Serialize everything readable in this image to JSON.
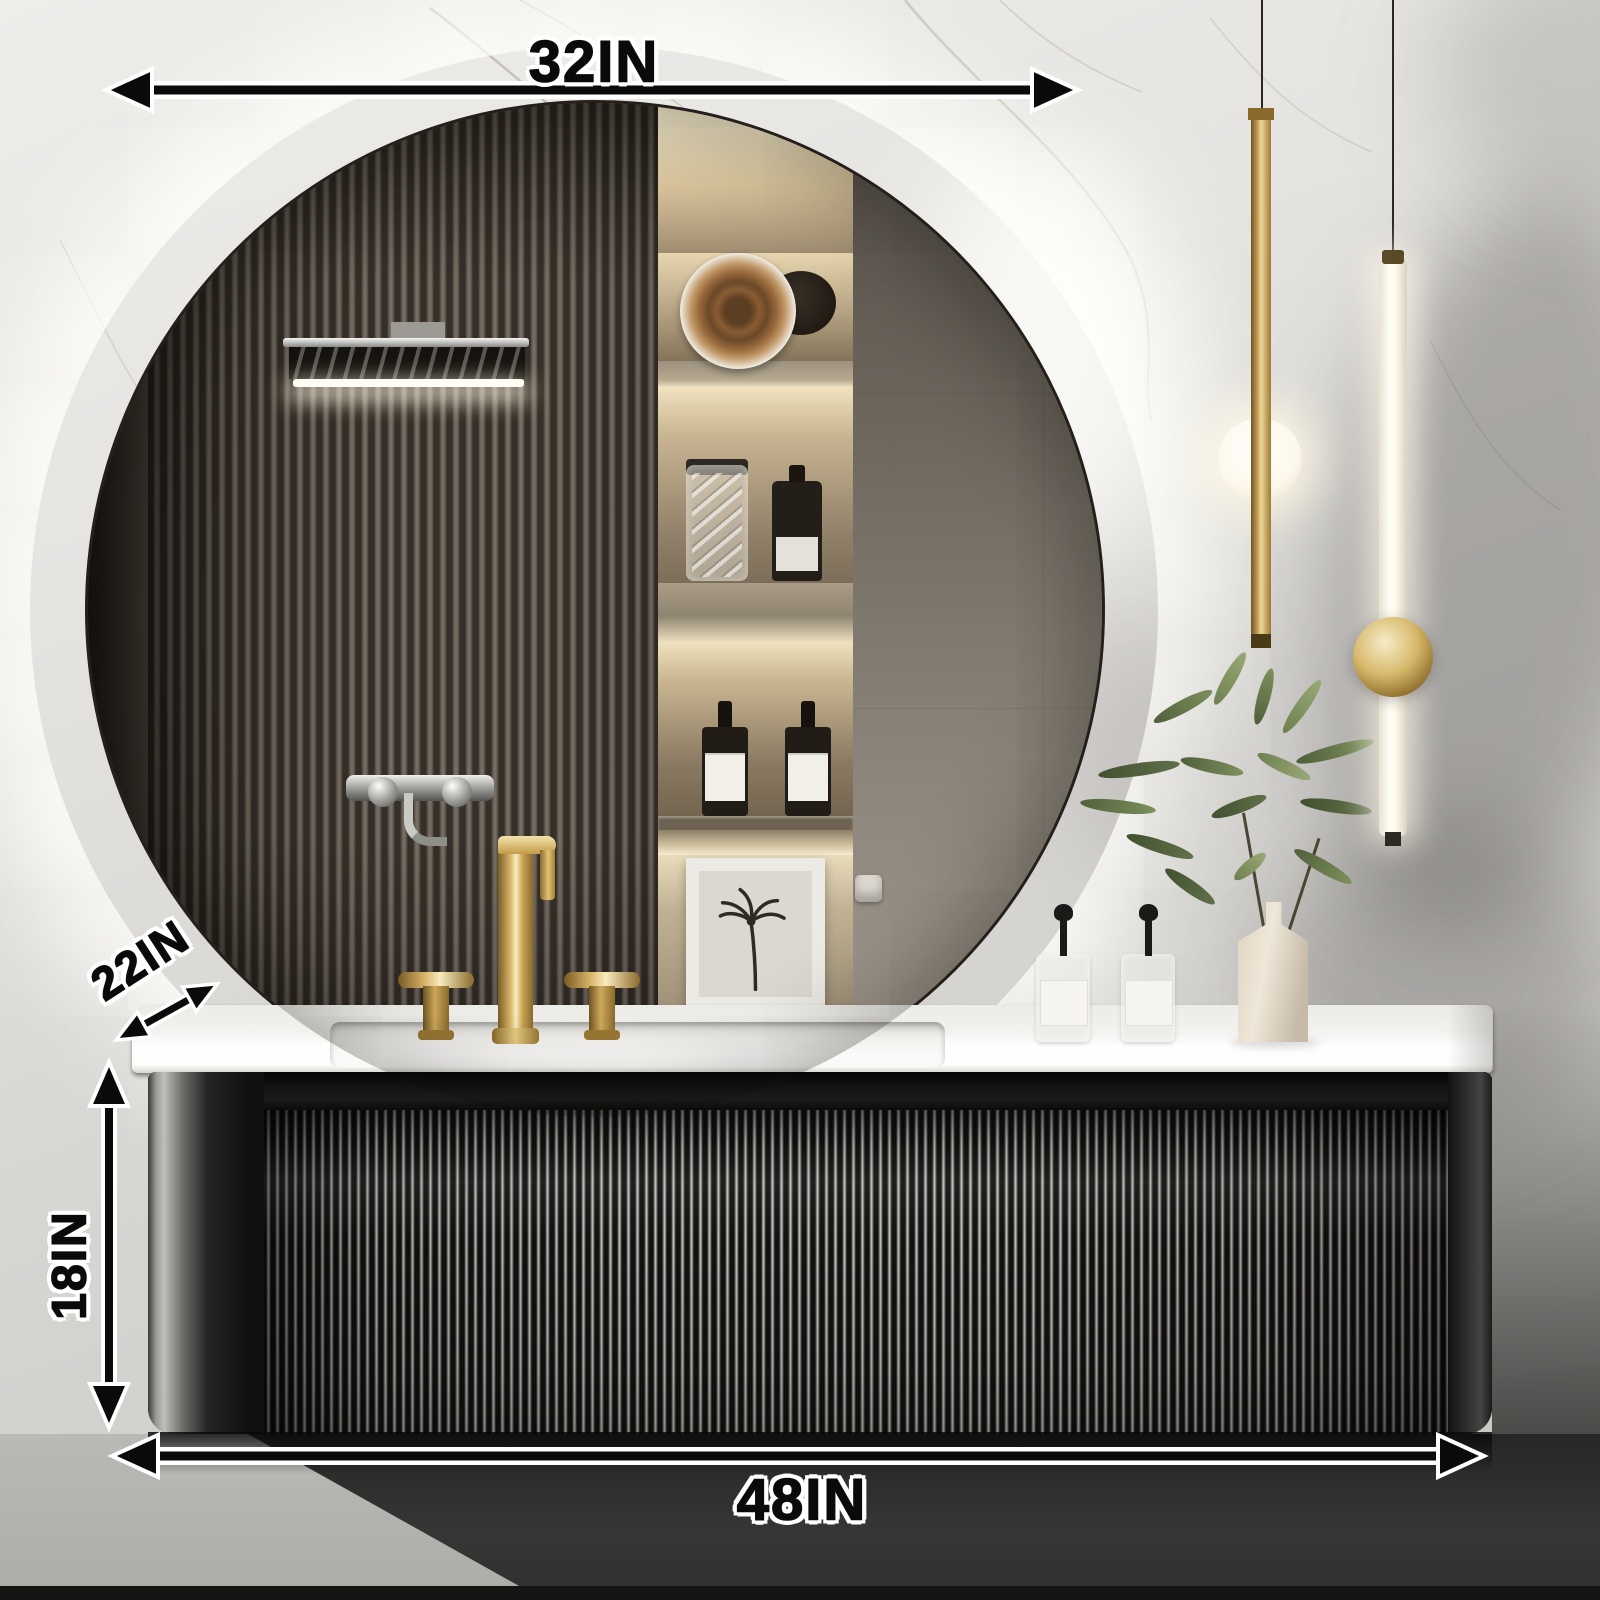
{
  "dimensions": {
    "mirror_width": {
      "label": "32IN",
      "orientation": "horizontal"
    },
    "counter_depth": {
      "label": "22IN",
      "orientation": "diagonal"
    },
    "cabinet_height": {
      "label": "18IN",
      "orientation": "vertical"
    },
    "cabinet_width": {
      "label": "48IN",
      "orientation": "horizontal"
    }
  },
  "colors": {
    "annotation_text": "#0a0a0a",
    "annotation_outline": "#ffffff",
    "brass_gold": "#c9a45c",
    "counter_white": "#f7f6f4",
    "cabinet_dark": "#141312",
    "wall_light": "#e7e5e2",
    "wood_slat": "#675e53",
    "leaf_green": "#6f8150",
    "vase_cream": "#ded3c0"
  }
}
